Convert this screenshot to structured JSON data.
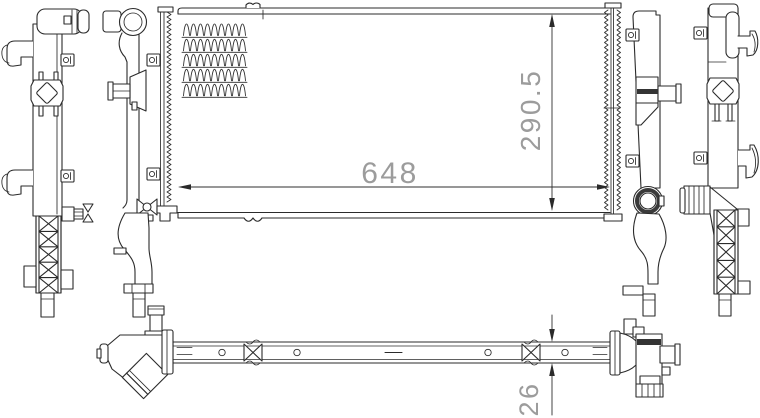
{
  "drawing": {
    "subject": "radiator-engineering-drawing",
    "background": "#ffffff",
    "line_color": "#2b2b2b",
    "dimension_text_color": "#9c9c9c",
    "dimensions": {
      "width": "648",
      "height": "290.5",
      "thickness": "26"
    }
  }
}
